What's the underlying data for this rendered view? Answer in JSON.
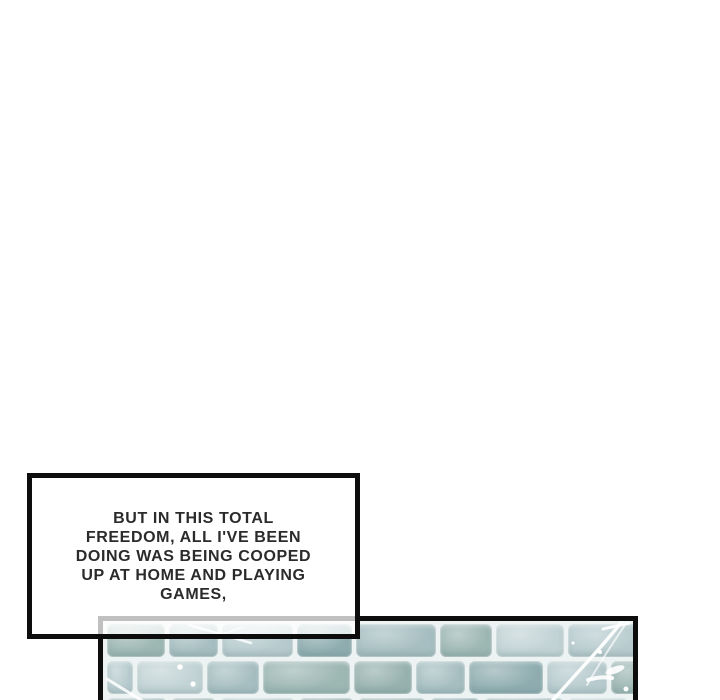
{
  "page": {
    "background": "#ffffff",
    "width": 720,
    "height": 700
  },
  "speech_bubble": {
    "lines": [
      "BUT IN THIS TOTAL",
      "FREEDOM, ALL I'VE BEEN",
      "DOING WAS BEING COOPED",
      "UP AT HOME AND PLAYING",
      "GAMES,"
    ],
    "text_color": "#2b2b2b",
    "border_color": "#0d0d0d",
    "fill": "rgba(255,255,255,0.74)"
  },
  "floor_panel": {
    "border_color": "#0d0d0d",
    "grout_color": "#edf3f2",
    "highlight_color": "#ffffff",
    "tile_palette": [
      "#a6bec1",
      "#b7cbce",
      "#9db7b3",
      "#8fadb0",
      "#c2d3d5",
      "#97b2ae"
    ],
    "rows": [
      {
        "y": 3,
        "h": 33,
        "bricks": [
          [
            58,
            2
          ],
          [
            49,
            0
          ],
          [
            71,
            1
          ],
          [
            55,
            3
          ],
          [
            80,
            0
          ],
          [
            52,
            2
          ],
          [
            68,
            4
          ],
          [
            77,
            1
          ]
        ]
      },
      {
        "y": 40,
        "h": 33,
        "bricks": [
          [
            26,
            1
          ],
          [
            66,
            4
          ],
          [
            52,
            0
          ],
          [
            87,
            2
          ],
          [
            58,
            5
          ],
          [
            49,
            0
          ],
          [
            74,
            3
          ],
          [
            60,
            1
          ],
          [
            45,
            2
          ]
        ]
      },
      {
        "y": 77,
        "h": 33,
        "bricks": [
          [
            60,
            0
          ],
          [
            45,
            2
          ],
          [
            75,
            1
          ],
          [
            55,
            5
          ],
          [
            68,
            2
          ],
          [
            50,
            3
          ],
          [
            80,
            0
          ],
          [
            60,
            4
          ]
        ]
      }
    ]
  }
}
